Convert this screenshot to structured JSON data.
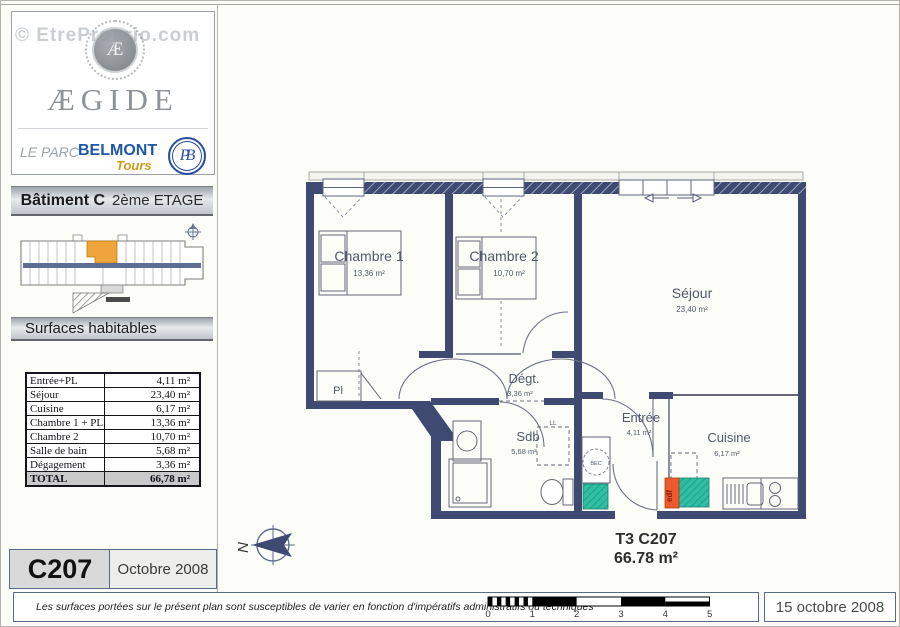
{
  "watermark": "© EtreProprio.com",
  "sidebar": {
    "logo": {
      "monogram": "Æ",
      "brand": "ÆGIDE",
      "residence_prefix": "LE PARC",
      "residence_name": "BELMONT",
      "residence_city": "Tours",
      "badge": "PB"
    },
    "building_header": {
      "building": "Bâtiment C",
      "floor": "2ème ETAGE"
    },
    "surfaces_title": "Surfaces habitables",
    "surface_table": {
      "rows": [
        {
          "label": "Entrée+PL",
          "value": "4,11 m²"
        },
        {
          "label": "Séjour",
          "value": "23,40 m²"
        },
        {
          "label": "Cuisine",
          "value": "6,17 m²"
        },
        {
          "label": "Chambre 1 + PL",
          "value": "13,36 m²"
        },
        {
          "label": "Chambre 2",
          "value": "10,70 m²"
        },
        {
          "label": "Salle de bain",
          "value": "5,68 m²"
        },
        {
          "label": "Dégagement",
          "value": "3,36 m²"
        }
      ],
      "total": {
        "label": "TOTAL",
        "value": "66,78 m²"
      }
    },
    "unit_code": "C207",
    "issue_date": "Octobre 2008"
  },
  "plan": {
    "rooms": [
      {
        "name": "Chambre 1",
        "area": "13,36 m²"
      },
      {
        "name": "Chambre 2",
        "area": "10,70 m²"
      },
      {
        "name": "Séjour",
        "area": "23,40 m²"
      },
      {
        "name": "Dégt.",
        "area": "3,36 m²"
      },
      {
        "name": "Sdb",
        "area": "5,68 m²"
      },
      {
        "name": "Entrée",
        "area": "4,11 m²"
      },
      {
        "name": "Cuisine",
        "area": "6,17 m²"
      }
    ],
    "labels": {
      "closet": "Pl",
      "washer": "LL",
      "duct": "BEC",
      "edf": "edf"
    },
    "summary": {
      "type_code": "T3 C207",
      "area": "66.78 m²"
    },
    "compass_letter": "N"
  },
  "footer": {
    "disclaimer": "Les surfaces portées sur le présent plan sont susceptibles de varier en fonction d'impératifs administratifs ou techniques",
    "scale_ticks": [
      "0",
      "1",
      "2",
      "3",
      "4",
      "5"
    ],
    "date": "15 octobre 2008"
  },
  "colors": {
    "wall_navy": "#3e4a72",
    "teal_duct": "#2fbfa3",
    "edf_orange": "#ed5a2d",
    "highlight_orange": "#efa43c",
    "brand_blue": "#1d57a5",
    "gold": "#cf9a1d"
  }
}
